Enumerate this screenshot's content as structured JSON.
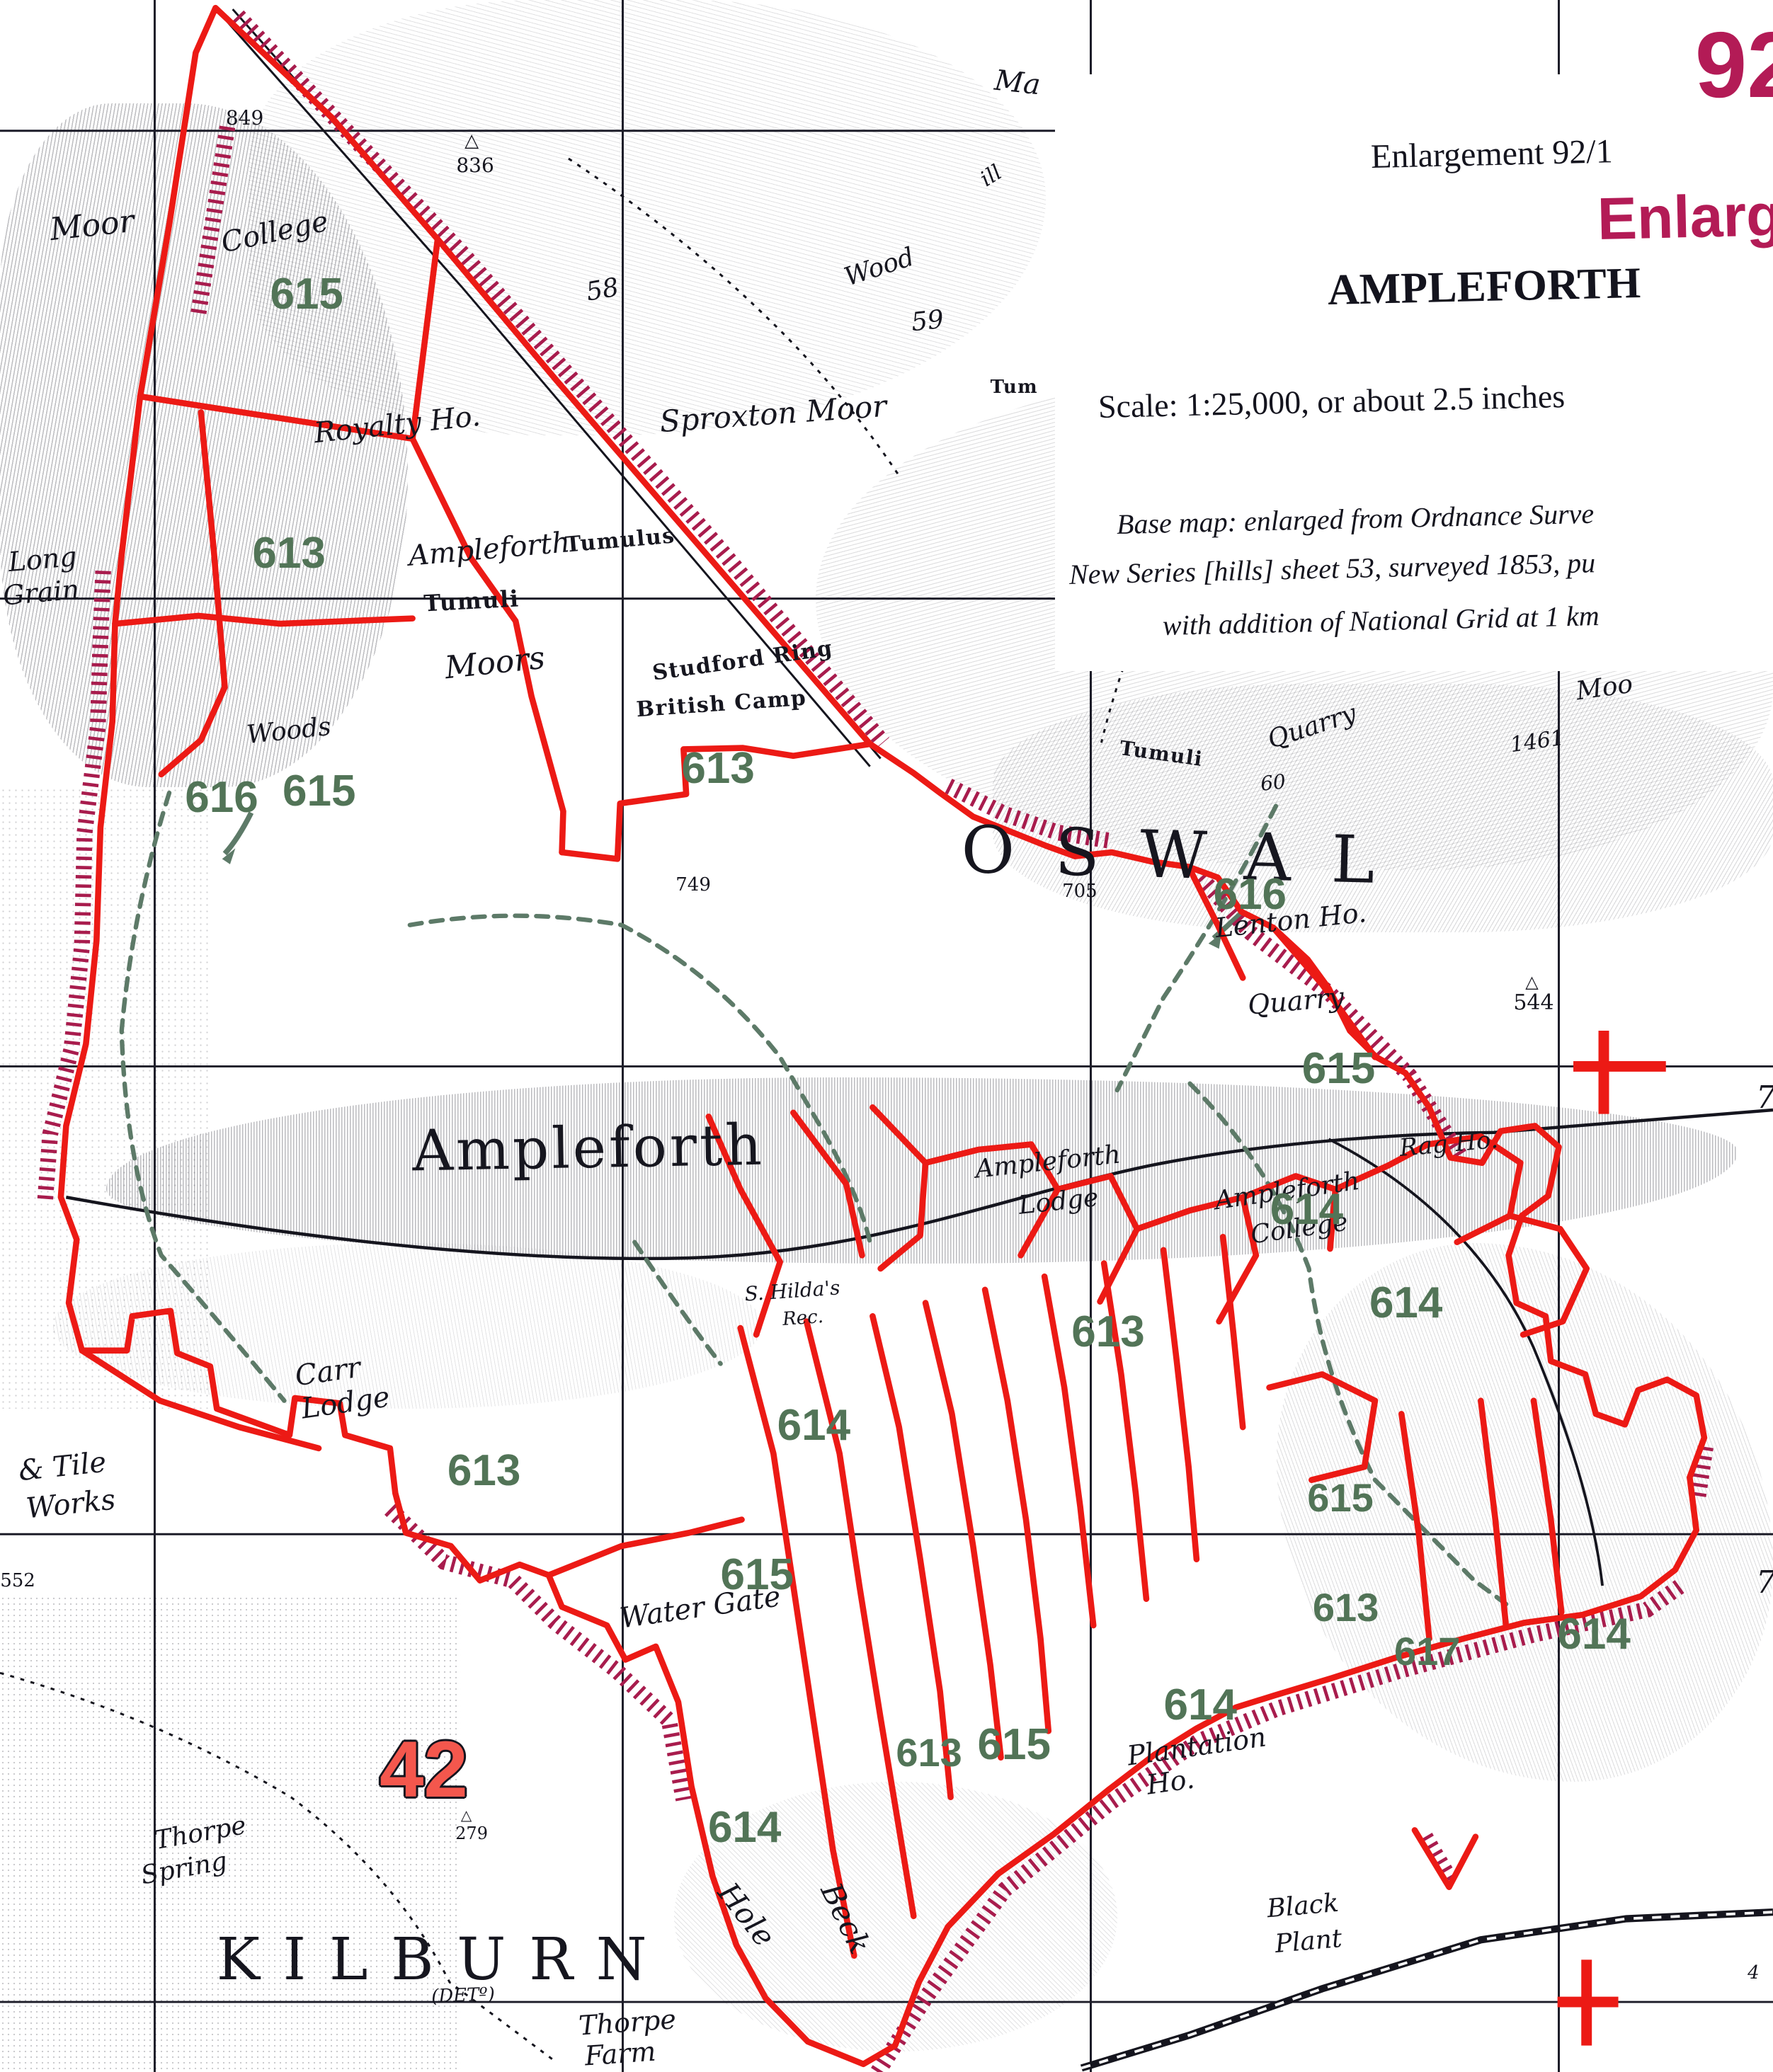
{
  "document": {
    "kind": "Scanned historical Ordnance Survey map enlargement with boundary overlay",
    "sheet": "Ampleforth"
  },
  "colors": {
    "paper": "#ffffff",
    "ink": "#16161f",
    "boundary_red": "#ec1a15",
    "hatch_crimson": "#a81c4d",
    "parcel_green": "#527457",
    "green_path": "#5d7a68",
    "magenta": "#b31b56",
    "grid_red_number": "#f4574d"
  },
  "title_box": {
    "page_number": "92",
    "enlargement_line": "Enlargement 92/1",
    "enlargement_magenta_fragment": "Enlargement",
    "sheet_name": "AMPLEFORTH",
    "scale_line": "Scale:  1:25,000, or about 2.5 inches",
    "base_map_line1": "Base map:  enlarged from Ordnance Surve",
    "base_map_line2": "New Series [hills] sheet 53, surveyed 1853, pu",
    "base_map_line3": "with addition of National Grid at 1 km"
  },
  "parcel_numbers_visible": [
    "613",
    "614",
    "615",
    "616",
    "617"
  ],
  "grid_numbers": [
    "42",
    "7",
    "7",
    "4"
  ],
  "labels": [
    {
      "name": "label-moor-nw",
      "t": "Moor",
      "x": 5.2,
      "y": 10.9,
      "r": -6,
      "s": 44,
      "c": "it"
    },
    {
      "name": "label-college",
      "t": "College",
      "x": 15.5,
      "y": 11.2,
      "r": -12,
      "s": 40,
      "c": "it"
    },
    {
      "name": "spot-height-849",
      "t": "849",
      "x": 13.8,
      "y": 5.7,
      "r": 0,
      "s": 28,
      "c": "num"
    },
    {
      "name": "trig-point-836-icon",
      "t": "△",
      "x": 26.6,
      "y": 6.8,
      "r": 0,
      "s": 26,
      "c": "tri"
    },
    {
      "name": "spot-height-836",
      "t": "836",
      "x": 26.8,
      "y": 8.0,
      "r": 0,
      "s": 28,
      "c": "num"
    },
    {
      "name": "field-number-58",
      "t": "58",
      "x": 34.0,
      "y": 14.0,
      "r": -10,
      "s": 36,
      "c": "it"
    },
    {
      "name": "field-number-59",
      "t": "59",
      "x": 52.3,
      "y": 15.5,
      "r": -6,
      "s": 36,
      "c": "it"
    },
    {
      "name": "label-wood-ne",
      "t": "Wood",
      "x": 49.6,
      "y": 12.9,
      "r": -18,
      "s": 36,
      "c": "it"
    },
    {
      "name": "label-fragment-ma",
      "t": "Ma",
      "x": 57.4,
      "y": 4.0,
      "r": 6,
      "s": 40,
      "c": "it"
    },
    {
      "name": "label-fragment-ill",
      "t": "ill",
      "x": 55.9,
      "y": 8.5,
      "r": -32,
      "s": 30,
      "c": "it"
    },
    {
      "name": "label-tumuli-ne",
      "t": "Tum",
      "x": 57.2,
      "y": 18.7,
      "r": 0,
      "s": 26,
      "c": "goth"
    },
    {
      "name": "label-sproxton-moor",
      "t": "Sproxton Moor",
      "x": 43.6,
      "y": 20.0,
      "r": -4,
      "s": 42,
      "c": "it"
    },
    {
      "name": "label-royalty-ho",
      "t": "Royalty Ho.",
      "x": 22.4,
      "y": 20.5,
      "r": -6,
      "s": 40,
      "c": "it"
    },
    {
      "name": "label-ampleforth-moor",
      "t": "Ampleforth",
      "x": 27.6,
      "y": 26.5,
      "r": -5,
      "s": 40,
      "c": "it"
    },
    {
      "name": "label-tumuli-nw",
      "t": "Tumuli",
      "x": 26.6,
      "y": 29.0,
      "r": -3,
      "s": 32,
      "c": "goth"
    },
    {
      "name": "label-tumulus",
      "t": "Tumulus",
      "x": 35.0,
      "y": 26.1,
      "r": -5,
      "s": 30,
      "c": "goth"
    },
    {
      "name": "label-moors",
      "t": "Moors",
      "x": 27.9,
      "y": 32.0,
      "r": -6,
      "s": 44,
      "c": "it"
    },
    {
      "name": "label-studford-ring",
      "t": "Studford Ring",
      "x": 41.9,
      "y": 31.9,
      "r": -8,
      "s": 30,
      "c": "goth"
    },
    {
      "name": "label-british-camp",
      "t": "British Camp",
      "x": 40.7,
      "y": 34.0,
      "r": -4,
      "s": 30,
      "c": "goth"
    },
    {
      "name": "parcel-613-camp",
      "t": "613",
      "x": 40.5,
      "y": 37.1,
      "r": 0,
      "s": 62,
      "c": "green"
    },
    {
      "name": "parcel-613-nw",
      "t": "613",
      "x": 16.3,
      "y": 26.7,
      "r": 0,
      "s": 62,
      "c": "green"
    },
    {
      "name": "label-woods-w",
      "t": "Woods",
      "x": 16.3,
      "y": 35.3,
      "r": -6,
      "s": 36,
      "c": "it"
    },
    {
      "name": "parcel-616-w",
      "t": "616",
      "x": 12.5,
      "y": 38.5,
      "r": 0,
      "s": 62,
      "c": "green"
    },
    {
      "name": "parcel-615-w",
      "t": "615",
      "x": 18.0,
      "y": 38.2,
      "r": 0,
      "s": 62,
      "c": "green"
    },
    {
      "name": "label-long-grain-1",
      "t": "Long",
      "x": 2.4,
      "y": 27.0,
      "r": -5,
      "s": 38,
      "c": "it"
    },
    {
      "name": "label-long-grain-2",
      "t": "Grain",
      "x": 2.3,
      "y": 28.6,
      "r": -5,
      "s": 38,
      "c": "it"
    },
    {
      "name": "parcel-615-college",
      "t": "615",
      "x": 17.3,
      "y": 14.2,
      "r": 0,
      "s": 62,
      "c": "green"
    },
    {
      "name": "label-quarry-n",
      "t": "Quarry",
      "x": 74.0,
      "y": 35.1,
      "r": -18,
      "s": 36,
      "c": "it"
    },
    {
      "name": "field-number-60",
      "t": "60",
      "x": 71.8,
      "y": 37.8,
      "r": -6,
      "s": 28,
      "c": "it"
    },
    {
      "name": "label-tumuli-e",
      "t": "Tumuli",
      "x": 65.5,
      "y": 36.4,
      "r": 8,
      "s": 28,
      "c": "goth"
    },
    {
      "name": "label-oswal",
      "t": "OSWAL",
      "x": 67.0,
      "y": 41.3,
      "r": 1.5,
      "s": 92,
      "c": "spaced"
    },
    {
      "name": "spot-height-1461",
      "t": "1461",
      "x": 86.7,
      "y": 35.8,
      "r": -8,
      "s": 30,
      "c": "it"
    },
    {
      "name": "label-fragment-moo",
      "t": "Moo",
      "x": 90.5,
      "y": 33.2,
      "r": -8,
      "s": 36,
      "c": "it"
    },
    {
      "name": "spot-height-705",
      "t": "705",
      "x": 60.9,
      "y": 43.0,
      "r": 0,
      "s": 26,
      "c": "num"
    },
    {
      "name": "spot-height-749",
      "t": "749",
      "x": 39.1,
      "y": 42.7,
      "r": 0,
      "s": 26,
      "c": "num"
    },
    {
      "name": "parcel-616-e",
      "t": "616",
      "x": 70.5,
      "y": 43.2,
      "r": 0,
      "s": 62,
      "c": "green"
    },
    {
      "name": "label-lenton-ho",
      "t": "Lenton Ho.",
      "x": 72.8,
      "y": 44.4,
      "r": -6,
      "s": 38,
      "c": "it"
    },
    {
      "name": "label-quarry-s",
      "t": "Quarry",
      "x": 73.1,
      "y": 48.3,
      "r": -5,
      "s": 38,
      "c": "it"
    },
    {
      "name": "trig-point-544-icon",
      "t": "△",
      "x": 86.4,
      "y": 47.4,
      "r": 0,
      "s": 24,
      "c": "tri"
    },
    {
      "name": "spot-height-544",
      "t": "544",
      "x": 86.5,
      "y": 48.4,
      "r": 0,
      "s": 30,
      "c": "num"
    },
    {
      "name": "parcel-615-e",
      "t": "615",
      "x": 75.5,
      "y": 51.6,
      "r": 0,
      "s": 62,
      "c": "green"
    },
    {
      "name": "grid-number-7-upper",
      "t": "7",
      "x": 99.6,
      "y": 53.0,
      "r": 0,
      "s": 44,
      "c": "gridnum"
    },
    {
      "name": "grid-number-7-lower",
      "t": "7",
      "x": 99.6,
      "y": 76.4,
      "r": 0,
      "s": 44,
      "c": "gridnum"
    },
    {
      "name": "label-ampleforth-village",
      "t": "Ampleforth",
      "x": 33.2,
      "y": 55.4,
      "r": -1,
      "s": 80,
      "c": "bigname"
    },
    {
      "name": "label-ampleforth-lodge-1",
      "t": "Ampleforth",
      "x": 59.1,
      "y": 56.1,
      "r": -6,
      "s": 36,
      "c": "it"
    },
    {
      "name": "label-ampleforth-lodge-2",
      "t": "Lodge",
      "x": 59.7,
      "y": 58.0,
      "r": -6,
      "s": 36,
      "c": "it"
    },
    {
      "name": "label-rag-ho",
      "t": "Rag Ho.",
      "x": 81.7,
      "y": 55.2,
      "r": -5,
      "s": 34,
      "c": "it"
    },
    {
      "name": "label-ampleforth-college-1",
      "t": "Ampleforth",
      "x": 72.6,
      "y": 57.5,
      "r": -8,
      "s": 36,
      "c": "it"
    },
    {
      "name": "label-ampleforth-college-2",
      "t": "College",
      "x": 73.3,
      "y": 59.3,
      "r": -8,
      "s": 36,
      "c": "it"
    },
    {
      "name": "parcel-614-college",
      "t": "614",
      "x": 73.7,
      "y": 58.4,
      "r": 0,
      "s": 62,
      "c": "green"
    },
    {
      "name": "parcel-613-village",
      "t": "613",
      "x": 62.5,
      "y": 64.3,
      "r": 0,
      "s": 62,
      "c": "green"
    },
    {
      "name": "parcel-614-e",
      "t": "614",
      "x": 79.3,
      "y": 62.9,
      "r": 0,
      "s": 62,
      "c": "green"
    },
    {
      "name": "label-st-hildas-1",
      "t": "S. Hilda's",
      "x": 44.7,
      "y": 62.3,
      "r": -4,
      "s": 28,
      "c": "it"
    },
    {
      "name": "label-st-hildas-2",
      "t": "Rec.",
      "x": 45.3,
      "y": 63.6,
      "r": -4,
      "s": 26,
      "c": "it"
    },
    {
      "name": "label-carr-lodge-1",
      "t": "Carr",
      "x": 18.5,
      "y": 66.2,
      "r": -8,
      "s": 40,
      "c": "it"
    },
    {
      "name": "label-carr-lodge-2",
      "t": "Lodge",
      "x": 19.5,
      "y": 67.7,
      "r": -8,
      "s": 40,
      "c": "it"
    },
    {
      "name": "parcel-614-c",
      "t": "614",
      "x": 45.9,
      "y": 68.8,
      "r": 0,
      "s": 62,
      "c": "green"
    },
    {
      "name": "parcel-613-sw",
      "t": "613",
      "x": 27.3,
      "y": 71.0,
      "r": 0,
      "s": 62,
      "c": "green"
    },
    {
      "name": "label-tile-works-1",
      "t": "& Tile",
      "x": 3.5,
      "y": 70.8,
      "r": -6,
      "s": 40,
      "c": "it"
    },
    {
      "name": "label-tile-works-2",
      "t": "Works",
      "x": 4.0,
      "y": 72.6,
      "r": -6,
      "s": 40,
      "c": "it"
    },
    {
      "name": "parcel-615-watergate",
      "t": "615",
      "x": 42.7,
      "y": 76.0,
      "r": 0,
      "s": 62,
      "c": "green"
    },
    {
      "name": "label-water-gate",
      "t": "Water Gate",
      "x": 39.5,
      "y": 77.6,
      "r": -8,
      "s": 40,
      "c": "it"
    },
    {
      "name": "parcel-615-se",
      "t": "615",
      "x": 75.6,
      "y": 72.3,
      "r": 0,
      "s": 56,
      "c": "green"
    },
    {
      "name": "parcel-613-se",
      "t": "613",
      "x": 75.9,
      "y": 77.6,
      "r": 0,
      "s": 56,
      "c": "green"
    },
    {
      "name": "parcel-617",
      "t": "617",
      "x": 80.5,
      "y": 79.7,
      "r": 0,
      "s": 56,
      "c": "green"
    },
    {
      "name": "parcel-614-far-e",
      "t": "614",
      "x": 89.9,
      "y": 78.9,
      "r": 0,
      "s": 62,
      "c": "green"
    },
    {
      "name": "spot-height-552",
      "t": "552",
      "x": 1.0,
      "y": 76.3,
      "r": 0,
      "s": 26,
      "c": "num"
    },
    {
      "name": "grid-number-42",
      "t": "42",
      "x": 23.9,
      "y": 85.4,
      "r": 0,
      "s": 112,
      "c": "red42"
    },
    {
      "name": "trig-point-279-icon",
      "t": "△",
      "x": 26.3,
      "y": 87.6,
      "r": 0,
      "s": 20,
      "c": "tri"
    },
    {
      "name": "spot-height-279",
      "t": "279",
      "x": 26.6,
      "y": 88.5,
      "r": 0,
      "s": 24,
      "c": "num"
    },
    {
      "name": "label-thorpe-spring-1",
      "t": "Thorpe",
      "x": 11.3,
      "y": 88.5,
      "r": -10,
      "s": 36,
      "c": "it"
    },
    {
      "name": "label-thorpe-spring-2",
      "t": "Spring",
      "x": 10.4,
      "y": 90.2,
      "r": -10,
      "s": 36,
      "c": "it"
    },
    {
      "name": "label-kilburn",
      "t": "KILBURN",
      "x": 25.0,
      "y": 94.6,
      "r": 0,
      "s": 82,
      "c": "kilburn"
    },
    {
      "name": "label-kilburn-det",
      "t": "(DETº)",
      "x": 26.1,
      "y": 96.3,
      "r": -2,
      "s": 26,
      "c": "it"
    },
    {
      "name": "label-thorpe-farm-1",
      "t": "Thorpe",
      "x": 35.4,
      "y": 97.6,
      "r": -4,
      "s": 38,
      "c": "it"
    },
    {
      "name": "label-thorpe-farm-2",
      "t": "Farm",
      "x": 35.0,
      "y": 99.1,
      "r": -4,
      "s": 38,
      "c": "it"
    },
    {
      "name": "label-hole-beck-1",
      "t": "Hole",
      "x": 42.1,
      "y": 92.4,
      "r": 52,
      "s": 42,
      "c": "it"
    },
    {
      "name": "label-hole-beck-2",
      "t": "Beck",
      "x": 47.7,
      "y": 92.6,
      "r": 64,
      "s": 42,
      "c": "it"
    },
    {
      "name": "parcel-614-s",
      "t": "614",
      "x": 42.0,
      "y": 88.2,
      "r": 0,
      "s": 62,
      "c": "green"
    },
    {
      "name": "parcel-613-plantation",
      "t": "613",
      "x": 52.4,
      "y": 84.6,
      "r": 0,
      "s": 56,
      "c": "green"
    },
    {
      "name": "parcel-615-plantation",
      "t": "615",
      "x": 57.2,
      "y": 84.2,
      "r": 0,
      "s": 62,
      "c": "green"
    },
    {
      "name": "parcel-614-plantation",
      "t": "614",
      "x": 67.7,
      "y": 82.3,
      "r": 0,
      "s": 62,
      "c": "green"
    },
    {
      "name": "label-plantation-1",
      "t": "Plantation",
      "x": 67.5,
      "y": 84.3,
      "r": -8,
      "s": 38,
      "c": "it"
    },
    {
      "name": "label-plantation-2",
      "t": "Ho.",
      "x": 66.0,
      "y": 86.0,
      "r": -8,
      "s": 38,
      "c": "it"
    },
    {
      "name": "label-black-plant-1",
      "t": "Black",
      "x": 73.5,
      "y": 92.0,
      "r": -5,
      "s": 36,
      "c": "it"
    },
    {
      "name": "label-black-plant-2",
      "t": "Plant",
      "x": 73.8,
      "y": 93.7,
      "r": -5,
      "s": 36,
      "c": "it"
    },
    {
      "name": "grid-number-4",
      "t": "4",
      "x": 98.9,
      "y": 95.2,
      "r": 0,
      "s": 26,
      "c": "gridnum"
    }
  ]
}
